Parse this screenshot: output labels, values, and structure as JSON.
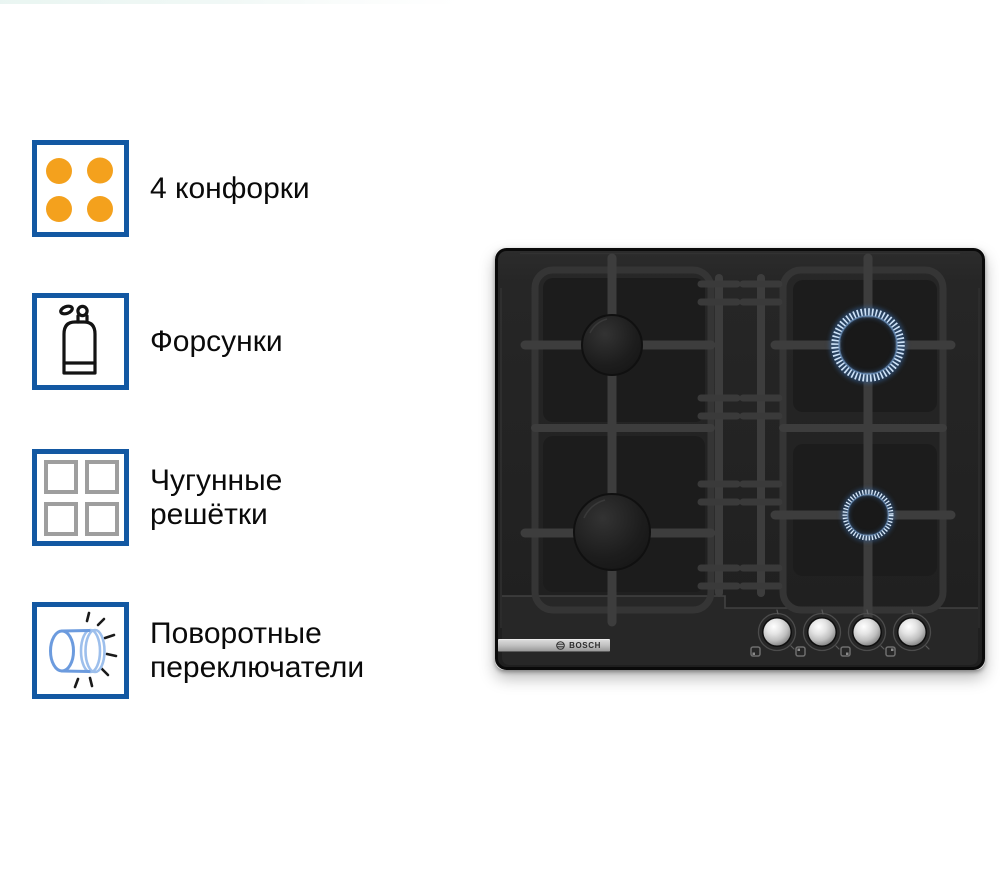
{
  "features": [
    {
      "icon": "four-burners-icon",
      "label": "4 конфорки"
    },
    {
      "icon": "gas-cylinder-icon",
      "label": "Форсунки"
    },
    {
      "icon": "cast-iron-grates-icon",
      "label": "Чугунные решётки"
    },
    {
      "icon": "rotary-knob-icon",
      "label": "Поворотные переключатели"
    }
  ],
  "product": {
    "brand": "BOSCH",
    "burner_count": 4,
    "knob_count": 4,
    "lit_flame_rings": 2
  },
  "colors": {
    "background": "#ffffff",
    "accent-blue": "#1358A2",
    "burner-orange": "#F4A11D",
    "grate-gray": "#9E9E9E",
    "icon-blue": "#6C9BDE",
    "icon-blue-light": "#9DBFEC",
    "flame-tick": "#CFE3F8",
    "flame-glow": "#35639B",
    "stove-body": "#232323",
    "text": "#0A0A0A"
  }
}
